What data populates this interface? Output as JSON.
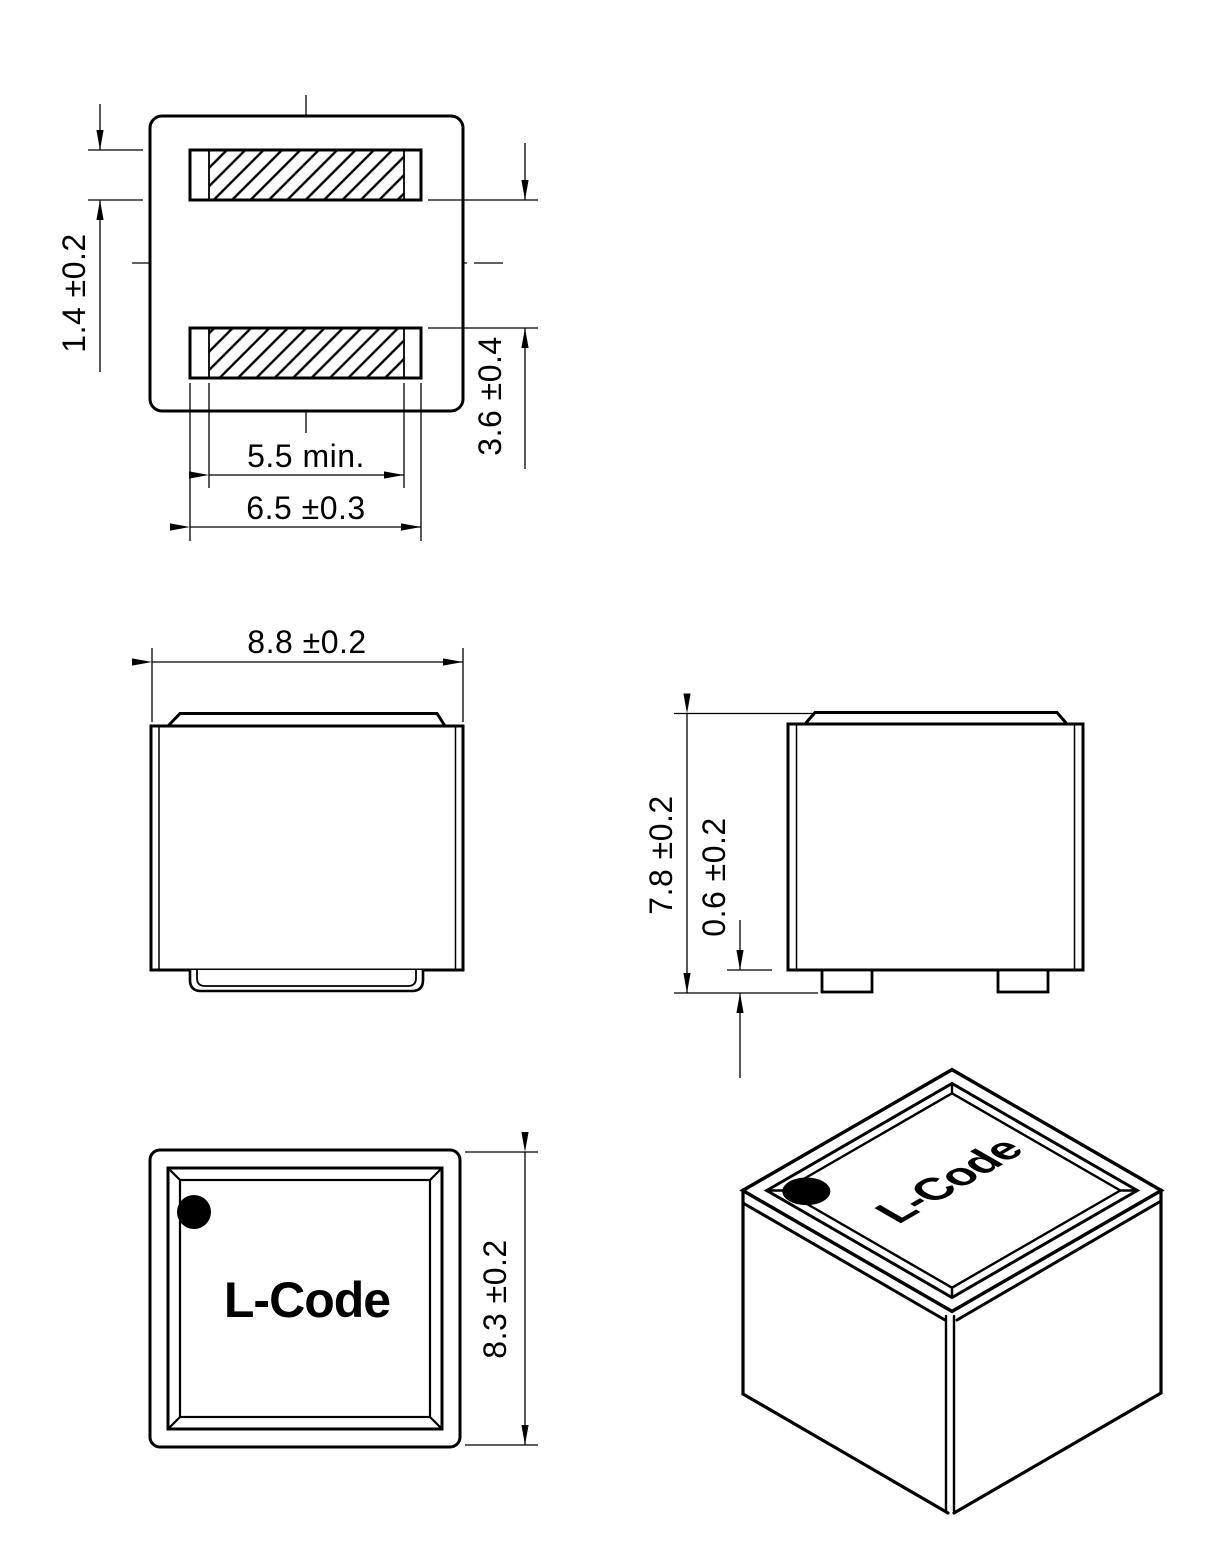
{
  "views": {
    "bottom_view": {
      "label_terminal_width": "1.4 ±0.2",
      "label_terminal_gap": "3.6 ±0.4",
      "label_solderable_min": "5.5 min.",
      "label_terminal_length": "6.5 ±0.3"
    },
    "front_view": {
      "label_body_width": "8.8 ±0.2"
    },
    "side_view": {
      "label_body_height": "7.8 ±0.2",
      "label_foot_height": "0.6 ±0.2"
    },
    "top_view": {
      "marking": "L-Code",
      "label_body_depth": "8.3 ±0.2"
    },
    "isometric_view": {
      "marking": "L-Code"
    }
  },
  "colors": {
    "line": "#000000",
    "background": "#ffffff"
  }
}
